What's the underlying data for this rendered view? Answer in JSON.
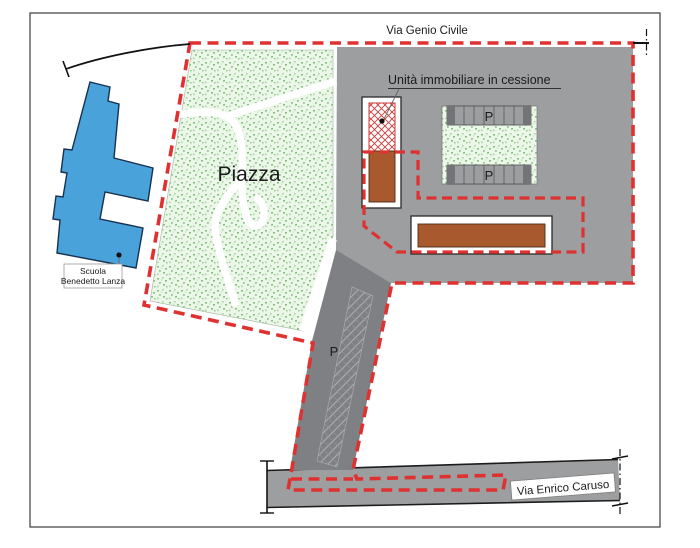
{
  "roads": {
    "top_label": "Via Genio Civile",
    "bottom_label": "Via Enrico Caruso"
  },
  "areas": {
    "piazza_label": "Piazza",
    "unit_label": "Unità immobiliare in cessione",
    "school_label_line1": "Scuola",
    "school_label_line2": "Benedetto Lanza"
  },
  "parking": {
    "p_label_top_row": "P",
    "p_label_bottom_row": "P",
    "p_label_access_road": "P"
  },
  "colors": {
    "boundary_red": "#e03131",
    "map_gray": "#9c9ea0",
    "road_dark_gray": "#7f8083",
    "school_blue": "#4aa2db",
    "building_brown": "#a85a2e",
    "green_dot": "#86c383",
    "hatch_red": "#cc3a3a"
  }
}
